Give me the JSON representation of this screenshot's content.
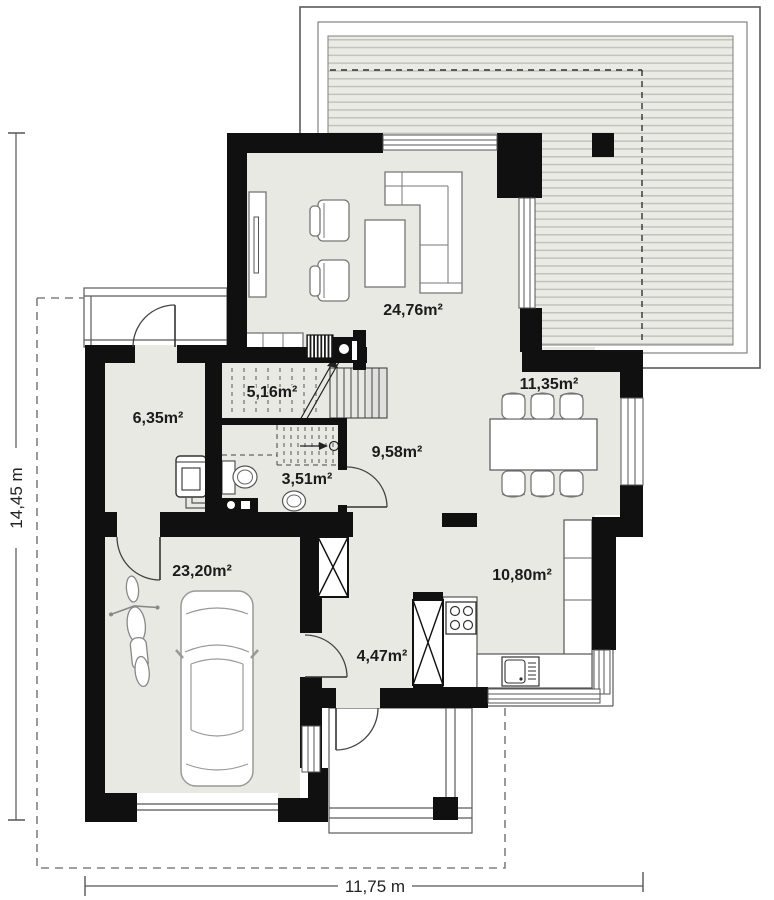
{
  "plan": {
    "title": "house-ground-floor-plan",
    "rooms": [
      {
        "name": "living-room",
        "area_label": "24,76m²"
      },
      {
        "name": "dining-room",
        "area_label": "11,35m²"
      },
      {
        "name": "stair-vestibule",
        "area_label": "5,16m²"
      },
      {
        "name": "utility-room",
        "area_label": "6,35m²"
      },
      {
        "name": "hall",
        "area_label": "9,58m²"
      },
      {
        "name": "wc",
        "area_label": "3,51m²"
      },
      {
        "name": "garage",
        "area_label": "23,20m²"
      },
      {
        "name": "kitchen",
        "area_label": "10,80m²"
      },
      {
        "name": "corridor",
        "area_label": "4,47m²"
      }
    ],
    "dimensions": {
      "width_label": "11,75 m",
      "height_label": "14,45 m"
    },
    "colors": {
      "wall": "#101010",
      "floor": "#e9e9e4",
      "deck_stripe": "#c2c2be",
      "deck_bg": "#ebebe6",
      "outline": "#5a5a5a"
    }
  }
}
